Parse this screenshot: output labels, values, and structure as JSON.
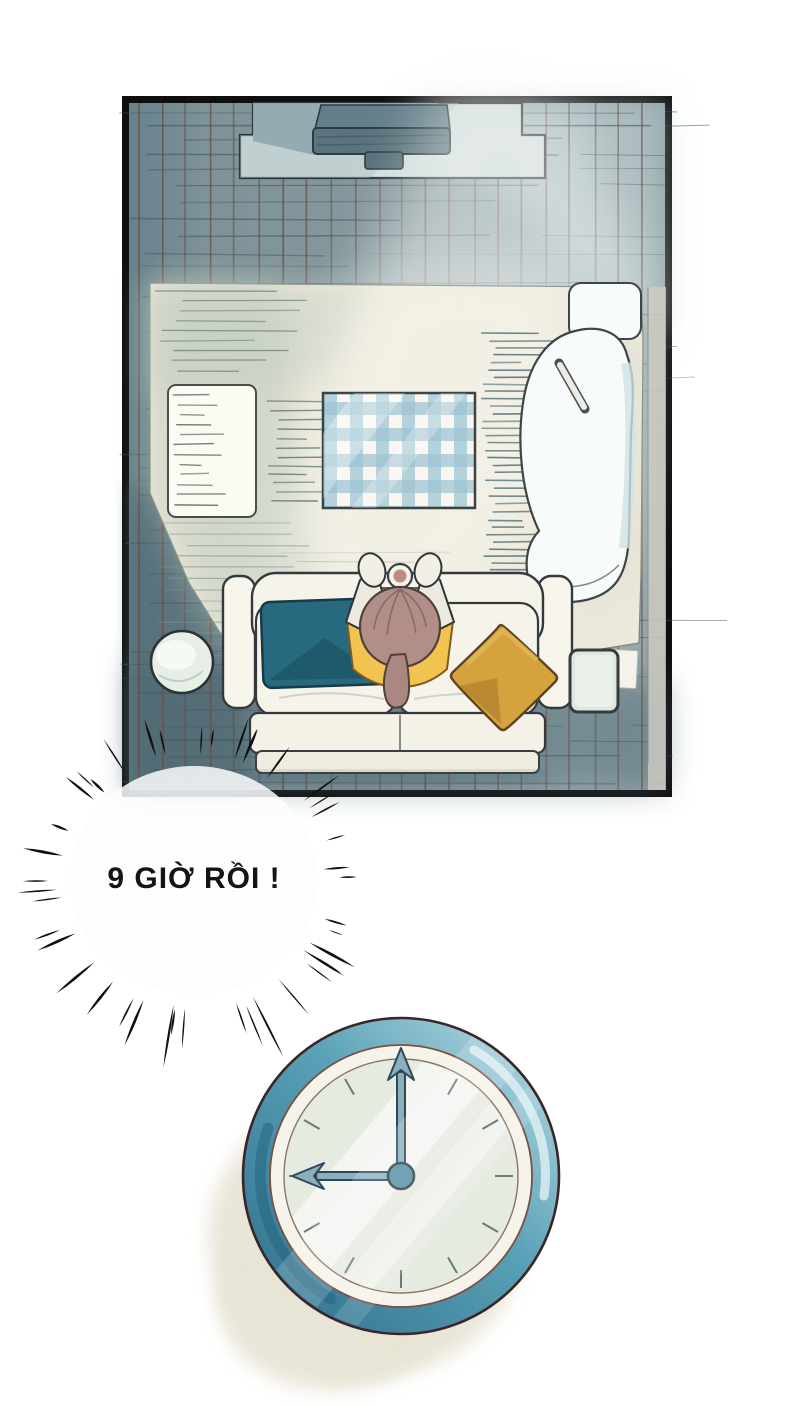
{
  "speech_bubble": {
    "text": "9 GIỜ RỒI !"
  },
  "clock": {
    "time": "9:00"
  },
  "icons": {
    "burst": "emphasis-burst-icon",
    "clock": "analog-wall-clock-icon",
    "remote": "remote-stick-icon"
  },
  "colors": {
    "page_background": "#ffffff",
    "panel_border": "#0f0f0f",
    "floor_teal": "#87999e",
    "floor_grid_vertical": "#6d4a43",
    "floor_grid_horizontal": "#415a62",
    "rug_cream": "#ede9da",
    "rug_shadow_green": "#b9c6ba",
    "blanket_blue": "#a9cbd8",
    "sofa_white": "#f6f4ea",
    "pillow_teal": "#27697e",
    "pillow_yellow": "#d4a33e",
    "shirt_yellow": "#f2c34e",
    "hair_brown": "#b18f88",
    "clock_rim_teal": "#4f93ad",
    "clock_face": "#e6ebe2",
    "clock_shadow_beige": "#e8e5d6",
    "burst_black": "#101010"
  }
}
